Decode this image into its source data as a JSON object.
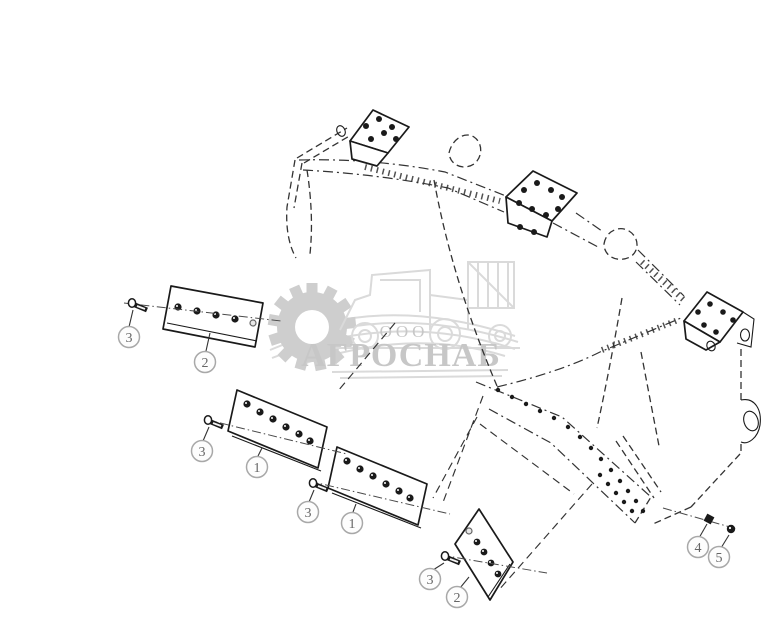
{
  "canvas": {
    "width": 781,
    "height": 641,
    "background": "#ffffff"
  },
  "watermark": {
    "org_form": "ООО",
    "company": "АГРОСНАБ",
    "color": "#c2c2c2"
  },
  "diagram": {
    "line_color": "#1a1a1a",
    "phantom_color": "#333333",
    "callout_ring_color": "#a8a8a8",
    "callout_text_color": "#666666",
    "callouts": [
      {
        "label": "3"
      },
      {
        "label": "2"
      },
      {
        "label": "3"
      },
      {
        "label": "1"
      },
      {
        "label": "3"
      },
      {
        "label": "1"
      },
      {
        "label": "3"
      },
      {
        "label": "2"
      },
      {
        "label": "4"
      },
      {
        "label": "5"
      }
    ]
  }
}
